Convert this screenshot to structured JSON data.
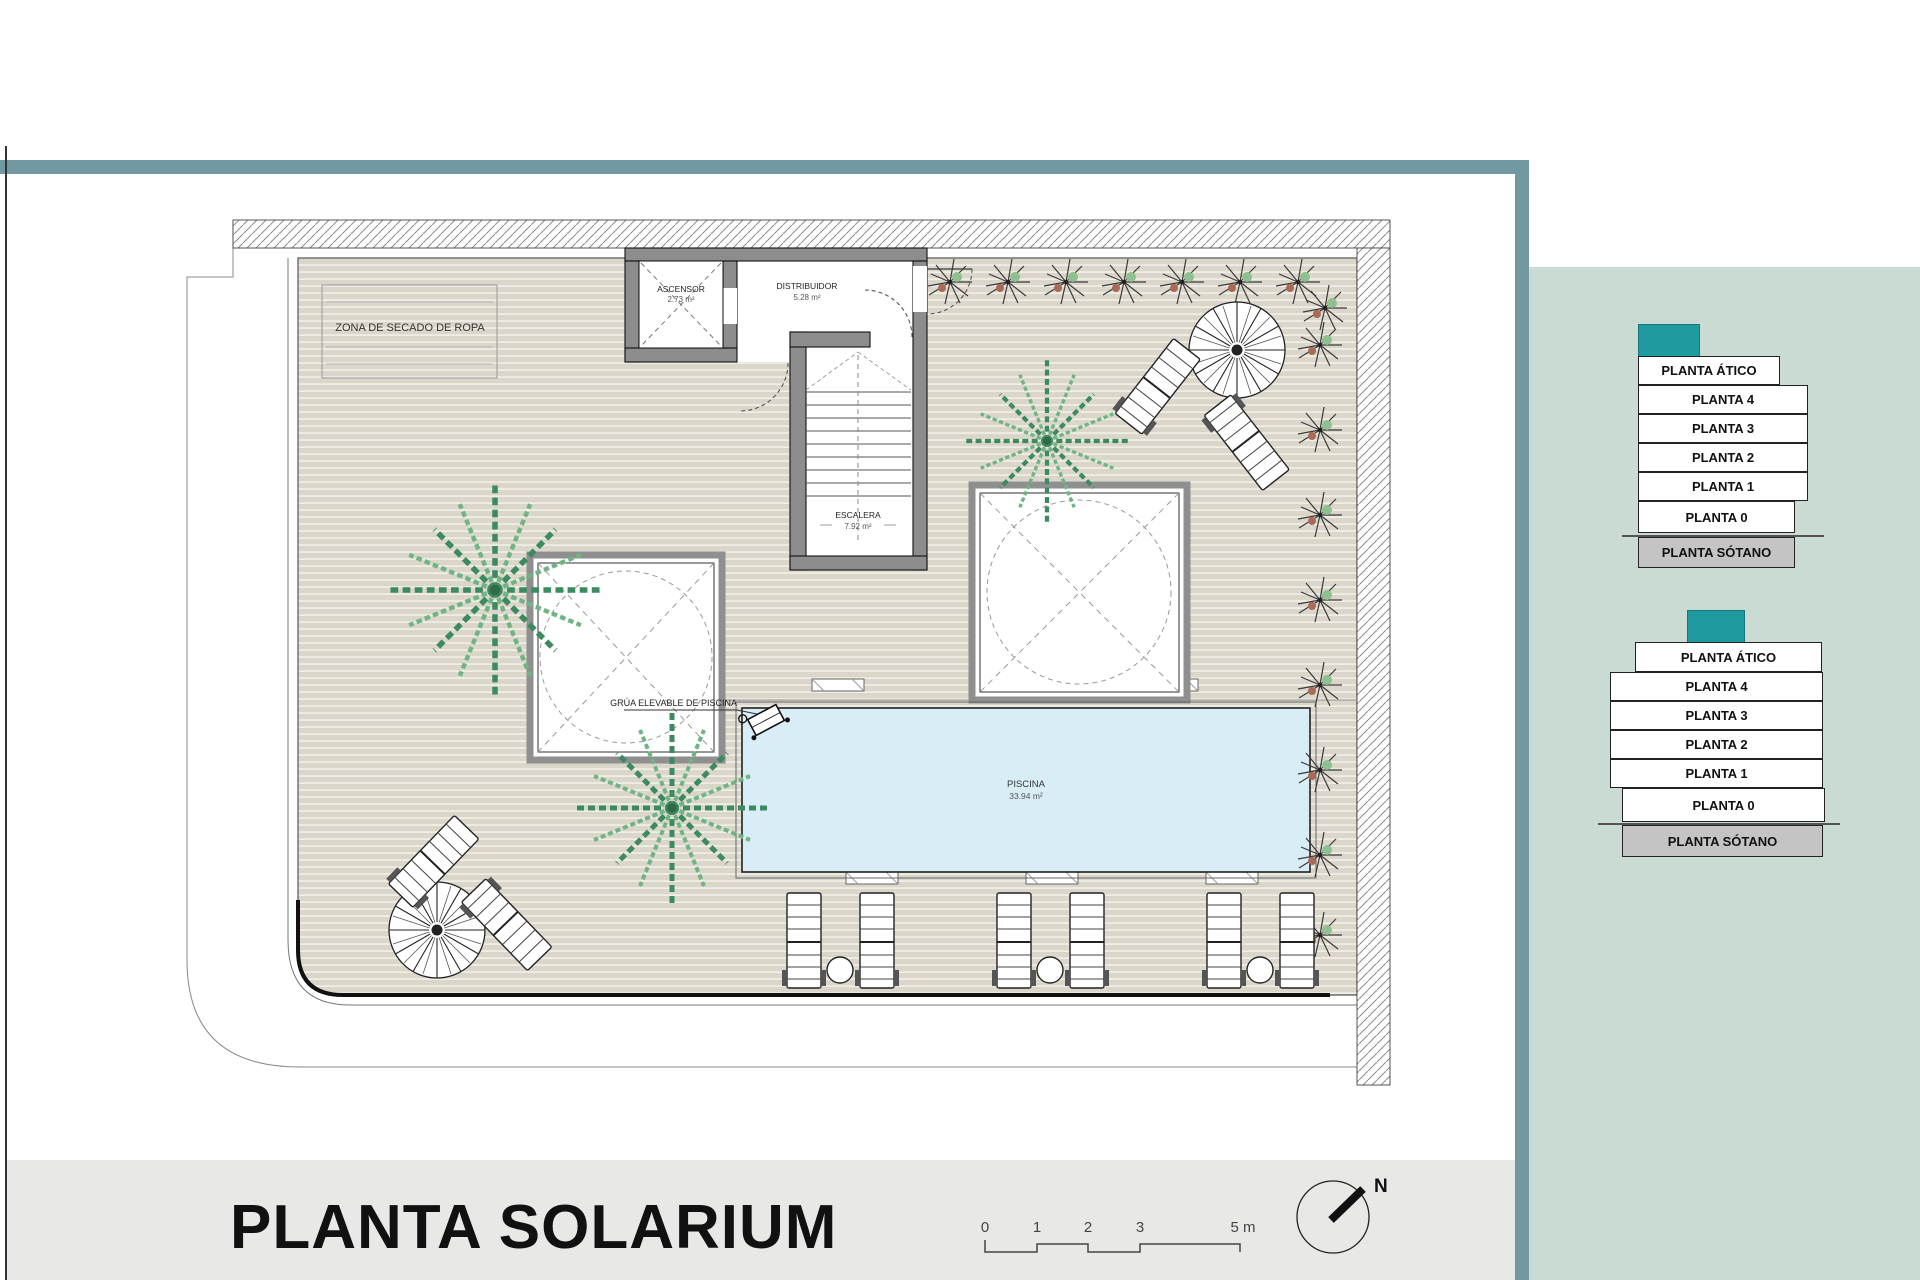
{
  "page": {
    "title": "PLANTA SOLARIUM"
  },
  "plan": {
    "zona_secado_label": "ZONA DE SECADO DE ROPA",
    "ascensor": {
      "name": "ASCENSOR",
      "area": "2.73 m²"
    },
    "distribuidor": {
      "name": "DISTRIBUIDOR",
      "area": "5.28 m²"
    },
    "escalera": {
      "name": "ESCALERA",
      "area": "7.92 m²"
    },
    "grua_label": "GRÚA ELEVABLE DE PISCINA",
    "piscina": {
      "name": "PISCINA",
      "area": "33.94 m²"
    }
  },
  "scale_bar": {
    "ticks": [
      "0",
      "1",
      "2",
      "3",
      "5 m"
    ]
  },
  "north": {
    "label": "N"
  },
  "stacks": [
    {
      "floors": [
        "PLANTA ÁTICO",
        "PLANTA 4",
        "PLANTA 3",
        "PLANTA 2",
        "PLANTA 1",
        "PLANTA 0",
        "PLANTA SÓTANO"
      ]
    },
    {
      "floors": [
        "PLANTA ÁTICO",
        "PLANTA 4",
        "PLANTA 3",
        "PLANTA 2",
        "PLANTA 1",
        "PLANTA 0",
        "PLANTA SÓTANO"
      ]
    }
  ],
  "colors": {
    "teal_bar": "#7299a1",
    "sage_panel": "#c9dbd3",
    "accent_teal": "#1f9aa0",
    "sotano_gray": "#c4c4c4",
    "title_band": "#e8e8e7",
    "pool_blue": "#d9edf6",
    "deck_beige": "#dbd6ca",
    "wall_gray": "#8d8d8d"
  }
}
